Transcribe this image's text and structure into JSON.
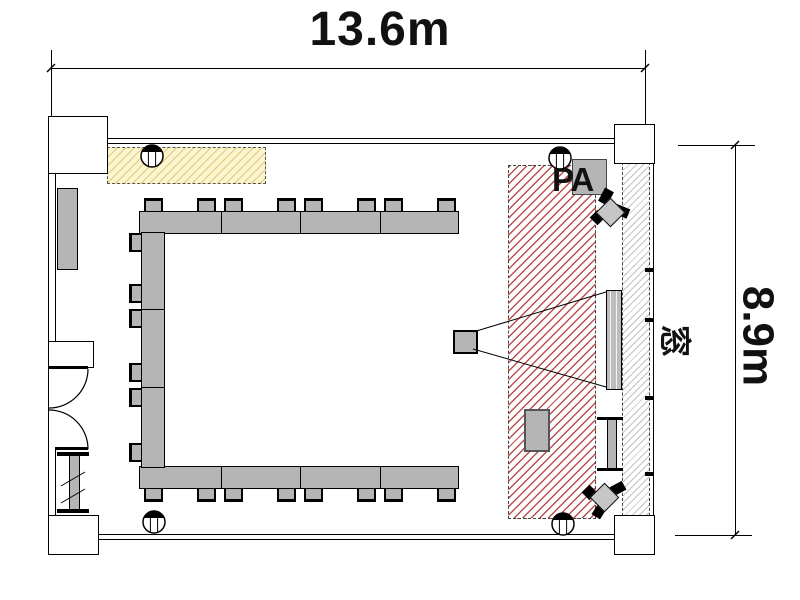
{
  "dimensions": {
    "width": "13.6m",
    "height": "8.9m"
  },
  "labels": {
    "window": "窓",
    "pa": "PA"
  },
  "colors": {
    "line": "#000000",
    "table_fill": "#b5b5b5",
    "stage_hatch_line": "#b85050",
    "board_bg": "#fcf5cf",
    "board_hatch_line": "#dcca7e",
    "window_hatch_line": "#c2c2c2",
    "speaker_fill": "#c6c6c6",
    "pa_box_fill": "#b5b5b5"
  },
  "icons": {
    "ceiling-fixture-icon": "circle with filled top segment and two vertical mullion lines",
    "speaker-icon": "tilted gray speaker box with black horn wedges",
    "door-icon": "double quarter-circle swing arcs",
    "projector-icon": "gray box with projection cone lines to screen"
  }
}
